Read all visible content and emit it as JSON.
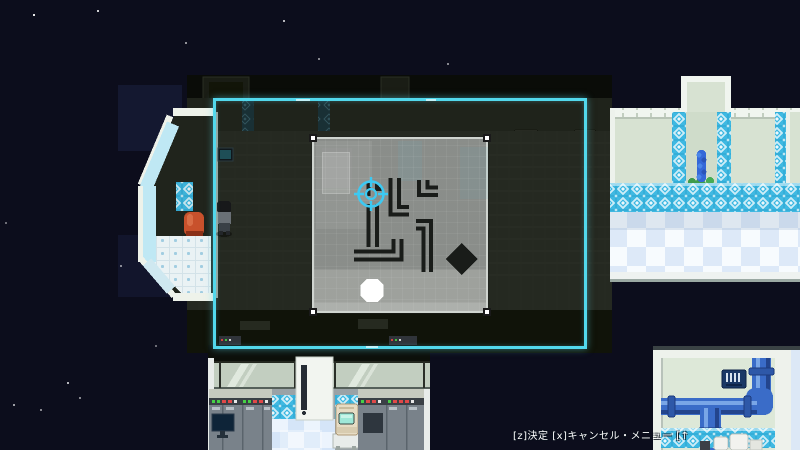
{
  "status_bar": {
    "text": "[z]決定 [x]キャンセル・メニュー [↑"
  },
  "colors": {
    "space_background": "#0c0d1c",
    "selection_frame": "#52d8ec",
    "target_cursor": "#3cc9f2",
    "puzzle_panel": "#939693",
    "pipe_piece": "#191c19",
    "goal_circle": "#ffffff",
    "diamond_block": "#191c19",
    "corridor_tile_teal": "#3cb6de",
    "pipe_blue": "#3a6cc8",
    "chair_orange": "#c8512c"
  },
  "puzzle": {
    "handle_count": 4,
    "pieces": [
      {
        "name": "fragment-under-cursor",
        "type": "elbow"
      },
      {
        "name": "vertical-straight",
        "type": "straight"
      },
      {
        "name": "elbow-up-right-large",
        "type": "elbow"
      },
      {
        "name": "elbow-up-right-small",
        "type": "elbow"
      },
      {
        "name": "elbow-left-down",
        "type": "elbow"
      },
      {
        "name": "elbow-left-up",
        "type": "elbow"
      },
      {
        "name": "diamond-block",
        "type": "diamond"
      },
      {
        "name": "goal-circle",
        "type": "circle"
      }
    ]
  },
  "scene": {
    "objects": [
      "bay-window",
      "player-character",
      "orange-chair",
      "wall-monitor",
      "vent-grate",
      "potted-plant",
      "corridor-checkered-floor",
      "lab-glass-wall",
      "server-cabinets",
      "desk-monitor",
      "door-panel",
      "retro-computer",
      "pipe-room",
      "pipe-vent",
      "white-machine",
      "stars"
    ]
  }
}
